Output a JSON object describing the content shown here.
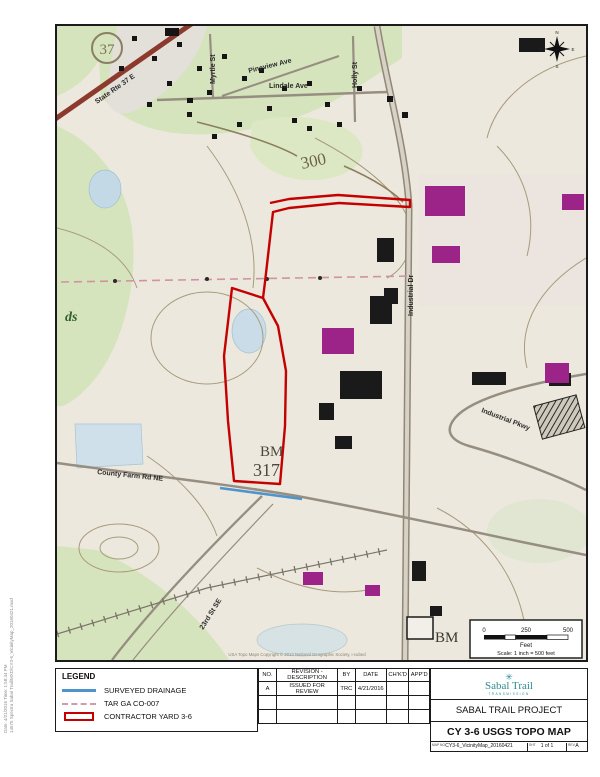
{
  "map": {
    "labels": {
      "shield": "37",
      "state_rte": "State Rte 37 E",
      "myrtle": "Myrtle St",
      "pineview": "Pineview Ave",
      "holly": "Holly St",
      "lindale": "Lindale Ave",
      "industrial_dr": "Industrial Dr",
      "industrial_pkwy": "Industrial Pkwy",
      "county_farm": "County Farm Rd NE",
      "street_23rd": "23rd St SE",
      "contour_300": "300",
      "bm_label": "BM",
      "bm_elev": "317",
      "bm2_label": "BM",
      "partial_place": "ds"
    },
    "compass": {
      "n": "N",
      "s": "S",
      "e": "E",
      "w": "W"
    },
    "credit": "USA Topo Maps Copyright © 2013 National Geographic Society, i-cubed",
    "scale_bar": {
      "t0": "0",
      "t1": "250",
      "t2": "500",
      "unit": "Feet",
      "text": "Scale: 1 inch = 500 feet"
    }
  },
  "margin_note": {
    "line1": "Date: 4/21/2016  Time: 1:58:44 PM",
    "line2": "14575 Spectra Sabal Trail\\MXD\\CY3-6_VicinityMap_20160421.mxd"
  },
  "legend": {
    "title": "LEGEND",
    "items": [
      {
        "label": "SURVEYED DRAINAGE"
      },
      {
        "label": "TAR GA CO-007"
      },
      {
        "label": "CONTRACTOR YARD 3-6"
      }
    ]
  },
  "revision_table": {
    "headers": [
      "NO.",
      "REVISION - DESCRIPTION",
      "BY",
      "DATE",
      "CH'K'D",
      "APP'D"
    ],
    "rows": [
      [
        "A",
        "ISSUED FOR REVIEW",
        "TRC",
        "4/21/2016",
        "",
        ""
      ],
      [
        "",
        "",
        "",
        "",
        "",
        ""
      ],
      [
        "",
        "",
        "",
        "",
        "",
        ""
      ]
    ]
  },
  "title_block": {
    "logo_name": "Sabal Trail",
    "logo_tagline": "TRANSMISSION",
    "project": "SABAL TRAIL PROJECT",
    "sheet_title": "CY 3-6 USGS TOPO MAP",
    "map_no_label": "MAP NO.",
    "map_no": "CY3-6_VicinityMap_20160421",
    "sheet_label": "SHT",
    "sheet": "1 of 1",
    "rev_label": "REV.",
    "rev": "A"
  },
  "colors": {
    "contractor_yard": "#c50000",
    "surveyed_drainage": "#4f94cd",
    "tar_line": "#cf9daa",
    "state_route_road": "#8c3a2e",
    "building_magenta": "#9c2387",
    "logo_teal": "#2e8b94"
  }
}
